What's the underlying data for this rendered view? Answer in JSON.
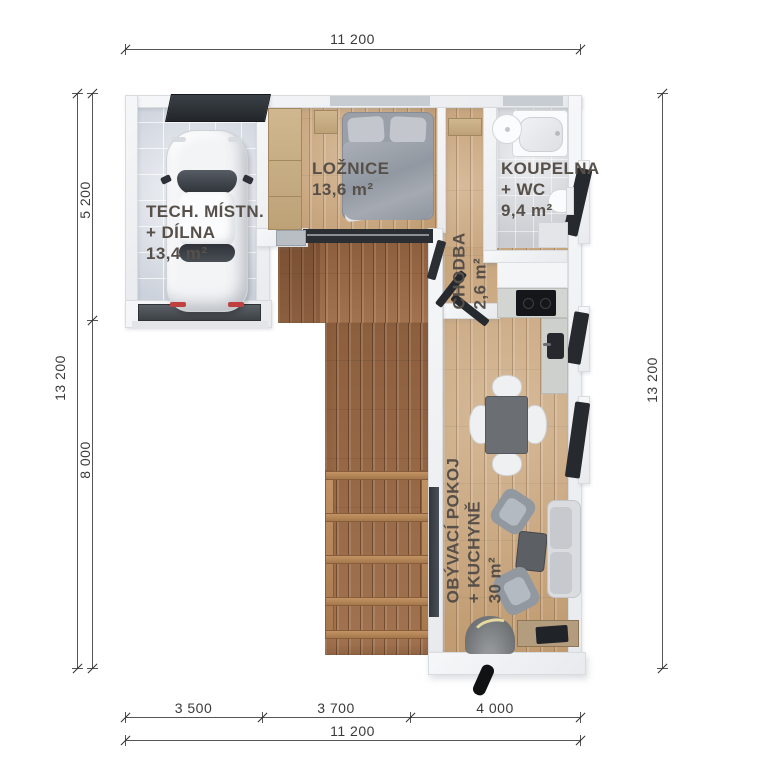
{
  "meta": {
    "type": "architectural floor plan, top-down 3D render"
  },
  "dims": {
    "top_total": "11 200",
    "bottom_seg1": "3 500",
    "bottom_seg2": "3 700",
    "bottom_seg3": "4 000",
    "bottom_total": "11 200",
    "left_total": "13 200",
    "left_upper": "5 200",
    "left_lower": "8 000",
    "right_total": "13 200"
  },
  "rooms": {
    "tech": {
      "name": "TECH. MÍSTN.",
      "name2": "+ DÍLNA",
      "area": "13,4 m²"
    },
    "bedroom": {
      "name": "LOŽNICE",
      "area": "13,6 m²"
    },
    "bath": {
      "name": "KOUPELNA",
      "name2": "+ WC",
      "area": "9,4 m²"
    },
    "hall": {
      "name": "CHODBA",
      "area": "2,6 m²"
    },
    "living": {
      "name": "OBÝVACÍ POKOJ",
      "name2": "+ KUCHYNĚ",
      "area": "30 m²"
    }
  },
  "colors": {
    "label": "#57504a",
    "dimension": "#555555",
    "deck_wood": "#9a6a47",
    "floor_wood": "#cba77d",
    "wall": "#eff1f3",
    "dark_fixture": "#2b2f33"
  }
}
